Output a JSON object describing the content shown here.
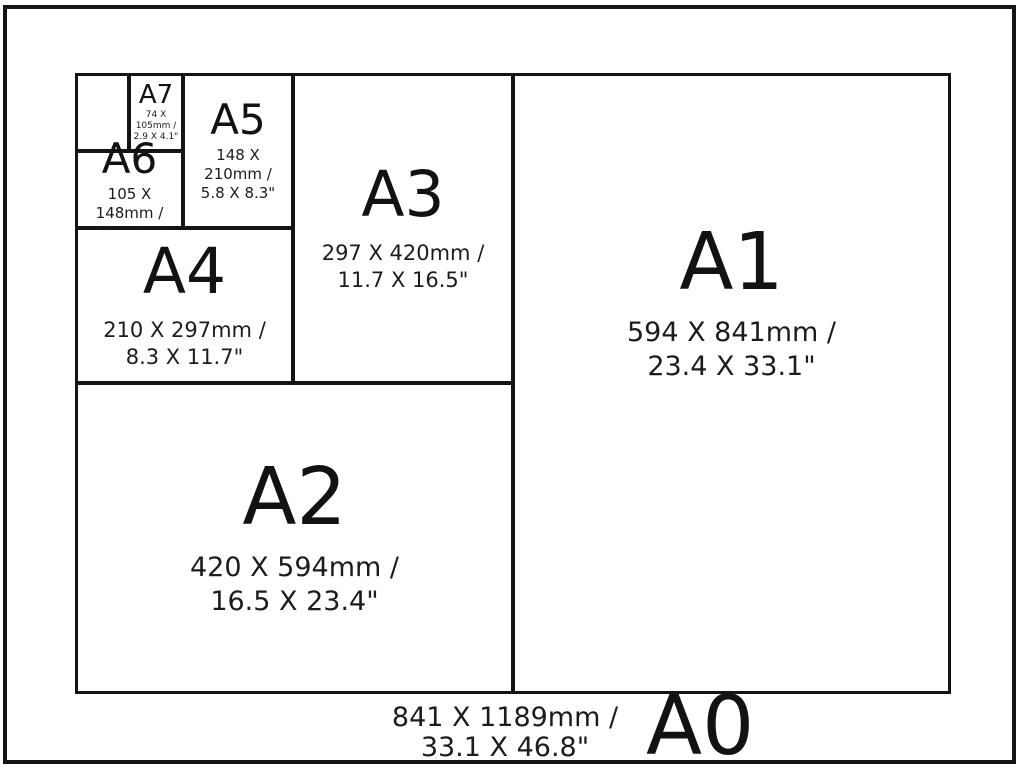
{
  "colors": {
    "background": "#ffffff",
    "line": "#141414",
    "text": "#141414"
  },
  "cells": {
    "a7": {
      "label": "A7",
      "mm": "74 X 105mm /",
      "inches": "2.9 X 4.1\""
    },
    "a6": {
      "label": "A6",
      "mm": "105 X 148mm /",
      "inches": "4.1 X 5.8\""
    },
    "a5": {
      "label": "A5",
      "mm": "148 X 210mm /",
      "inches": "5.8 X 8.3\""
    },
    "a4": {
      "label": "A4",
      "mm": "210 X 297mm /",
      "inches": "8.3 X 11.7\""
    },
    "a3": {
      "label": "A3",
      "mm": "297 X 420mm /",
      "inches": "11.7 X 16.5\""
    },
    "a2": {
      "label": "A2",
      "mm": "420 X 594mm /",
      "inches": "16.5 X 23.4\""
    },
    "a1": {
      "label": "A1",
      "mm": "594 X 841mm /",
      "inches": "23.4 X 33.1\""
    },
    "a0": {
      "label": "A0",
      "mm": "841 X 1189mm /",
      "inches": "33.1 X 46.8\""
    }
  }
}
